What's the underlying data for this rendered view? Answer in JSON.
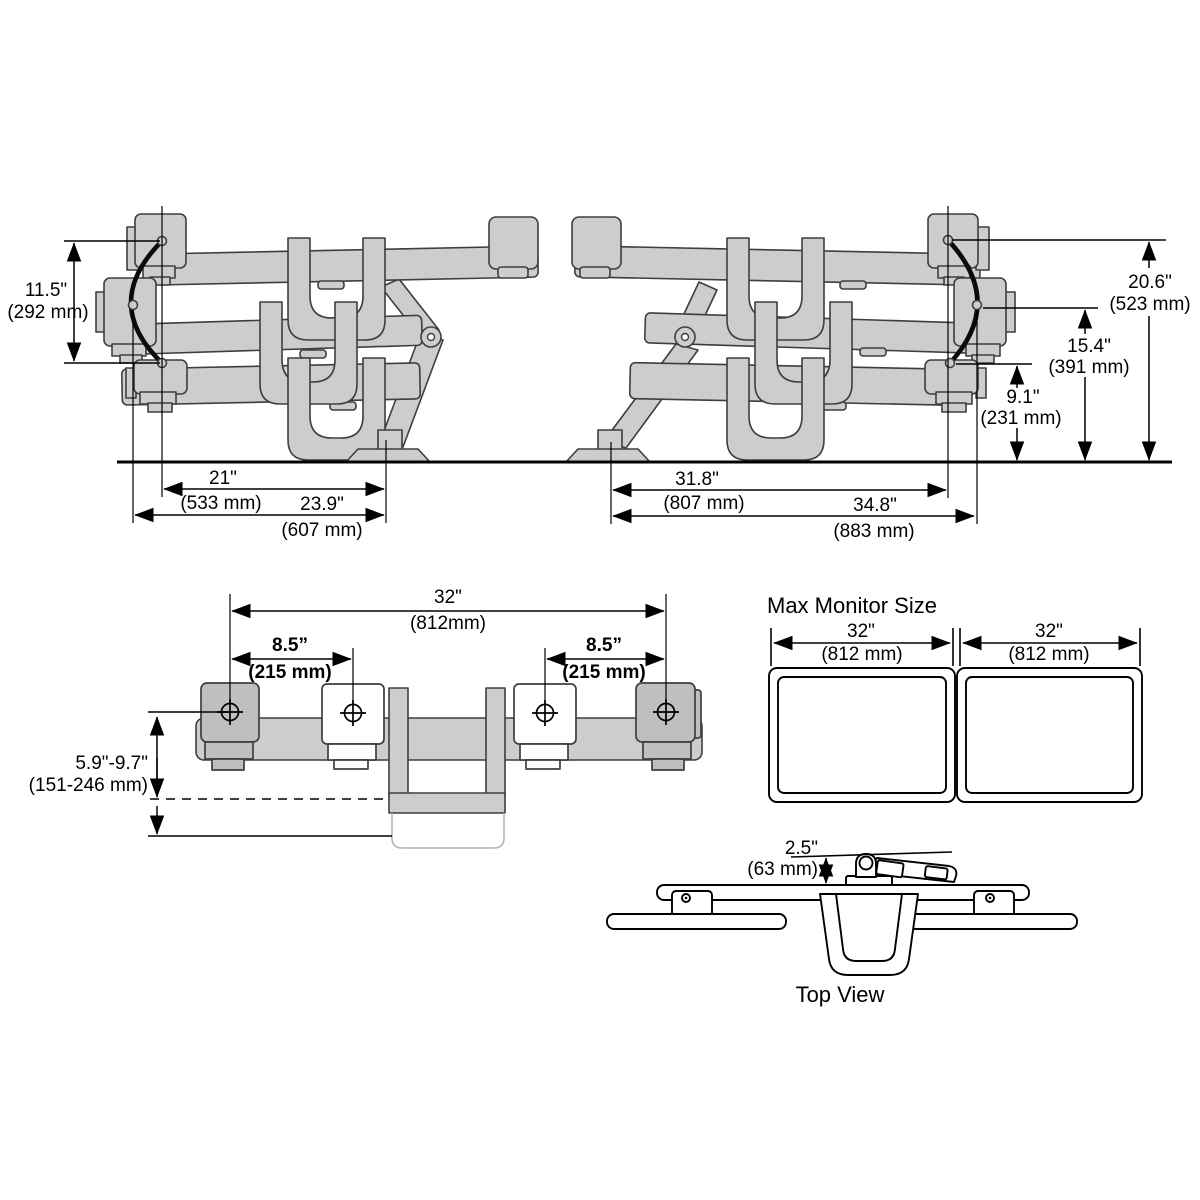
{
  "colors": {
    "background": "#ffffff",
    "part_fill": "#cdcdcd",
    "part_fill_dark": "#bfbfbf",
    "part_stroke": "#3e3e3e",
    "dim_color": "#000000"
  },
  "side_left": {
    "height_range_in": "11.5\"",
    "height_range_mm": "(292 mm)",
    "reach_in": "21\"",
    "reach_mm": "(533 mm)",
    "depth_in": "23.9\"",
    "depth_mm": "(607 mm)"
  },
  "side_right": {
    "height_top_in": "20.6\"",
    "height_top_mm": "(523 mm)",
    "height_mid_in": "15.4\"",
    "height_mid_mm": "(391 mm)",
    "height_low_in": "9.1\"",
    "height_low_mm": "(231 mm)",
    "reach_in": "31.8\"",
    "reach_mm": "(807 mm)",
    "depth_in": "34.8\"",
    "depth_mm": "(883 mm)"
  },
  "front": {
    "width_in": "32\"",
    "width_mm": "(812mm)",
    "offset_left_in": "8.5”",
    "offset_left_mm": "(215 mm)",
    "offset_right_in": "8.5”",
    "offset_right_mm": "(215 mm)",
    "lift_in": "5.9\"-9.7\"",
    "lift_mm": "(151-246 mm)"
  },
  "max_monitor": {
    "title": "Max Monitor Size",
    "left_in": "32\"",
    "left_mm": "(812 mm)",
    "right_in": "32\"",
    "right_mm": "(812 mm)"
  },
  "top_view": {
    "label": "Top View",
    "clearance_in": "2.5\"",
    "clearance_mm": "(63 mm)"
  }
}
